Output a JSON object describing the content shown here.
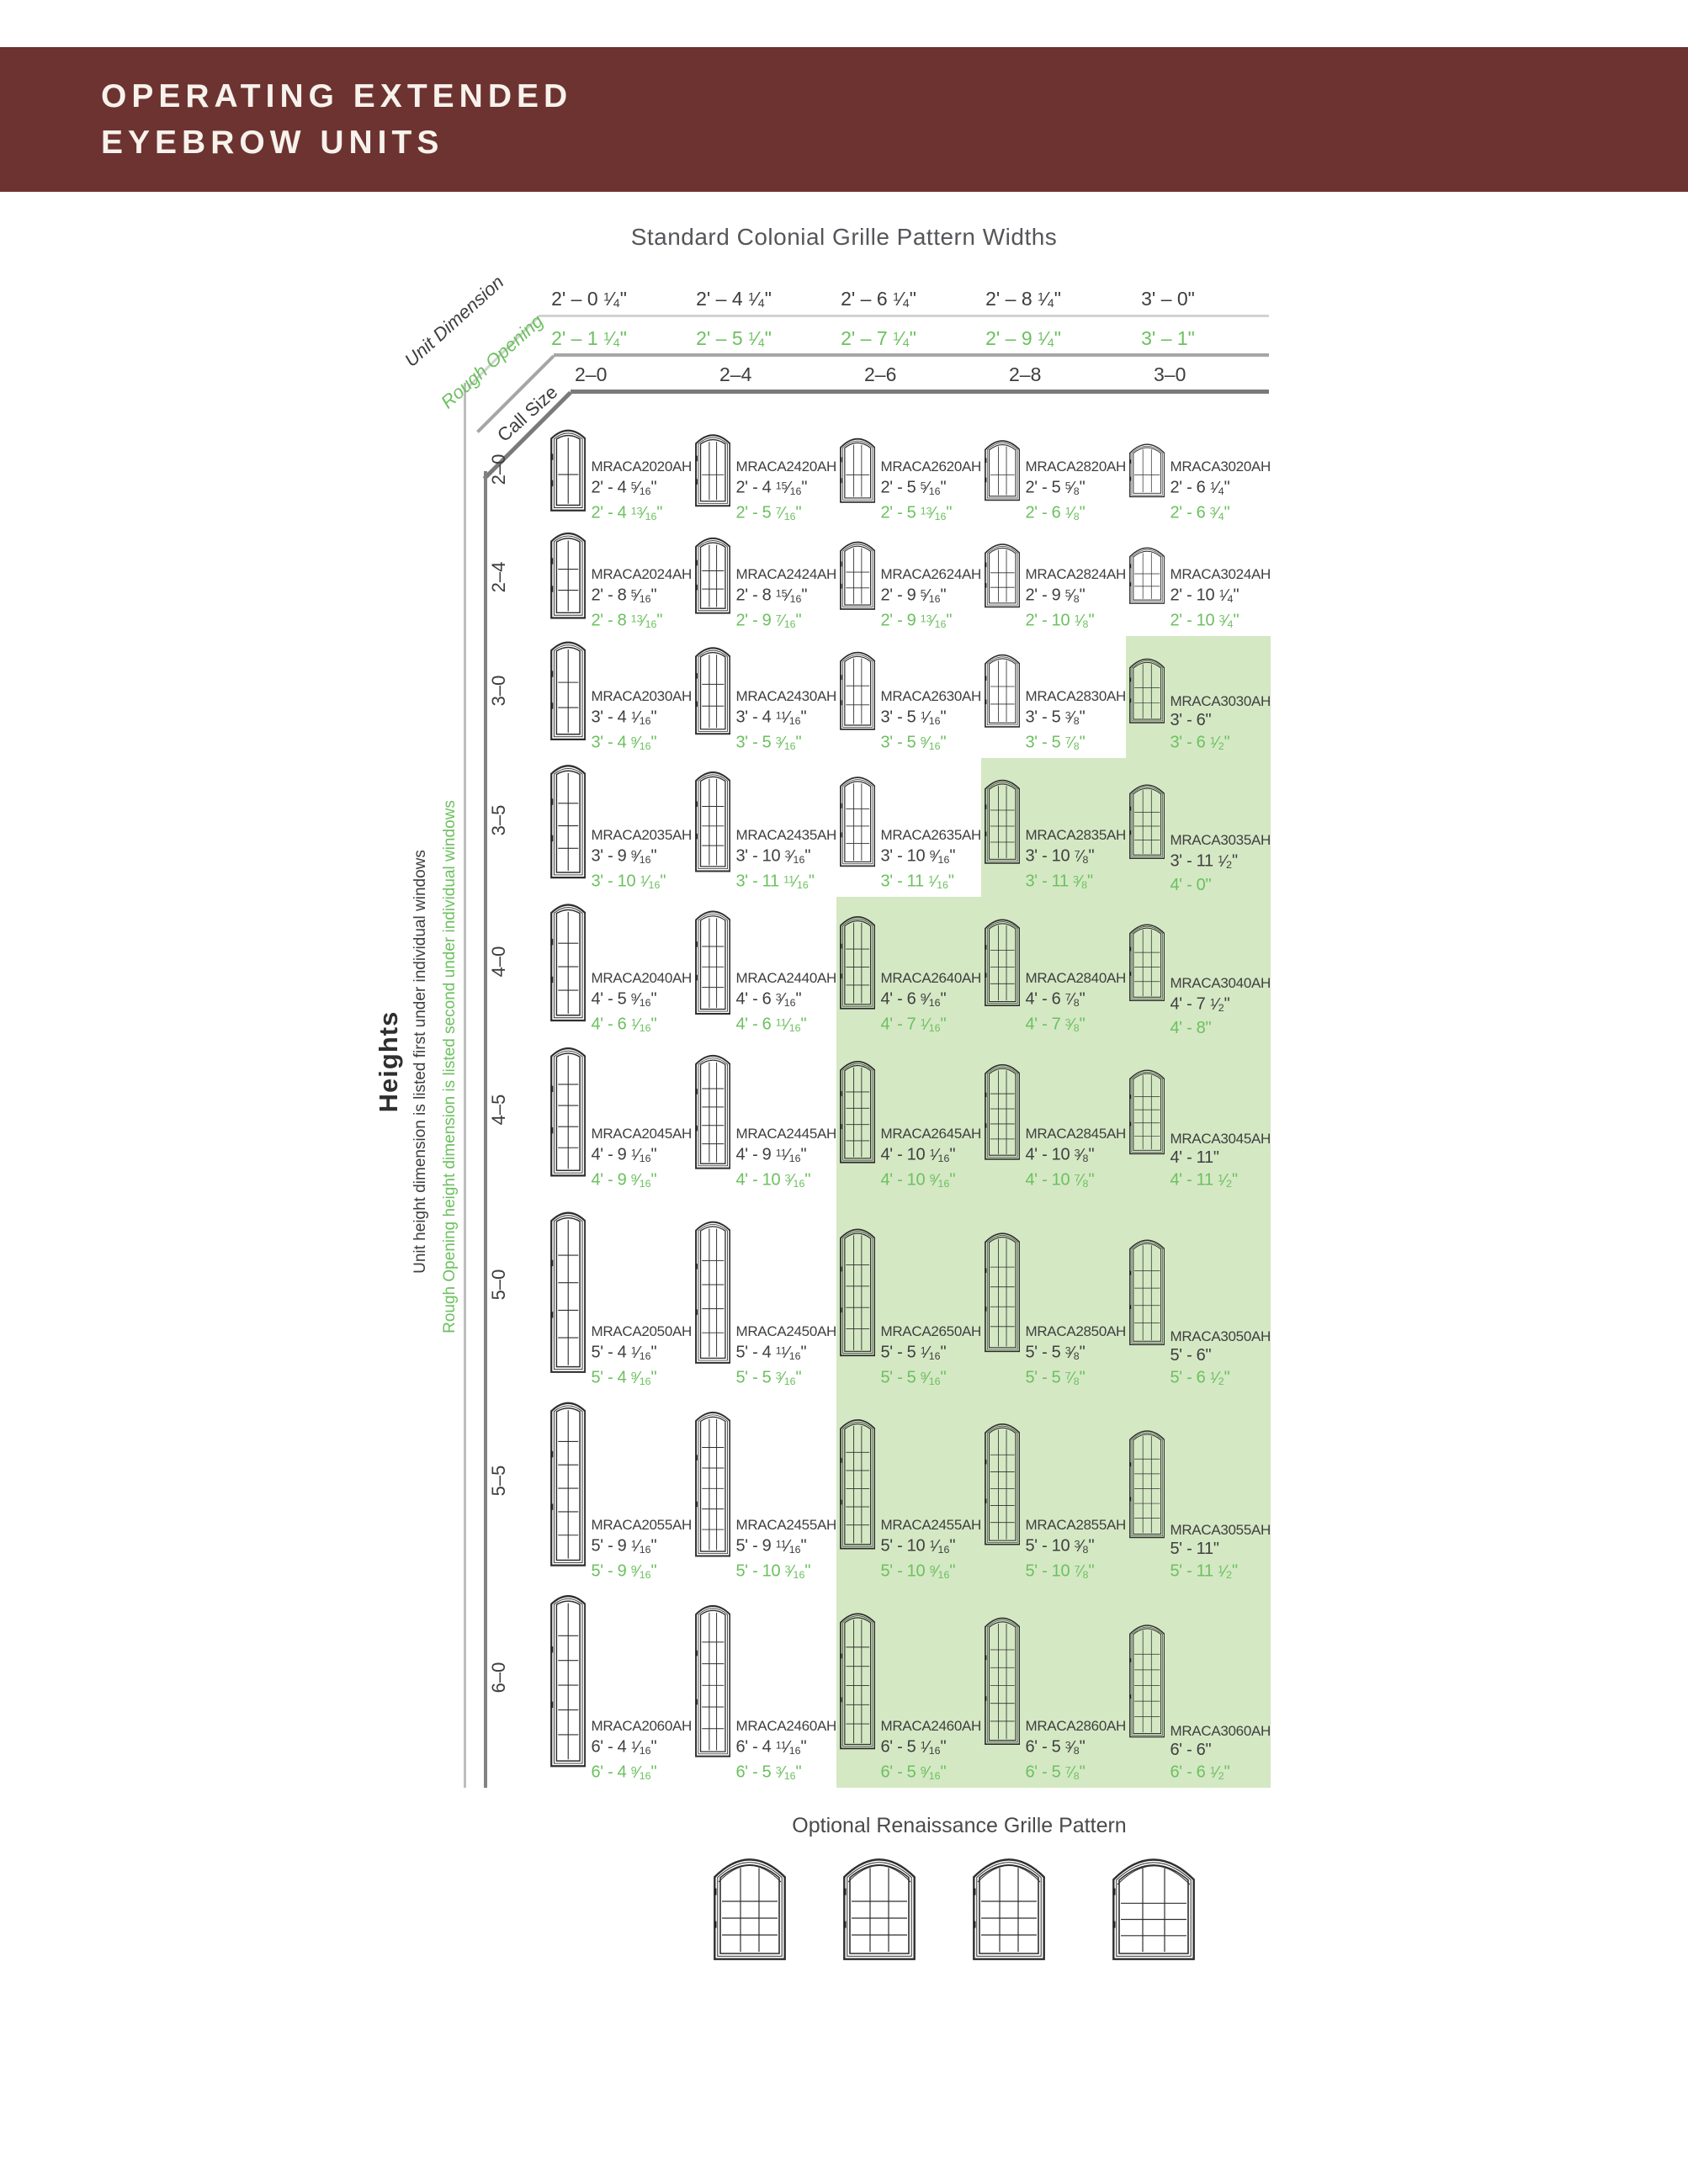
{
  "header": {
    "line1": "OPERATING EXTENDED",
    "line2": "EYEBROW UNITS"
  },
  "section_title": "Standard Colonial Grille Pattern Widths",
  "width_axis": {
    "unit_dimension_label": "Unit Dimension",
    "rough_opening_label": "Rough Opening",
    "call_size_label": "Call Size",
    "unit_dimensions": [
      "2' – 0 1/4\"",
      "2' – 4 1/4\"",
      "2' – 6 1/4\"",
      "2' – 8 1/4\"",
      "3' – 0\""
    ],
    "rough_openings": [
      "2' – 1 1/4\"",
      "2' – 5 1/4\"",
      "2' – 7 1/4\"",
      "2' – 9 1/4\"",
      "3' – 1\""
    ],
    "call_sizes": [
      "2–0",
      "2–4",
      "2–6",
      "2–8",
      "3–0"
    ]
  },
  "height_axis": {
    "title": "Heights",
    "unit_note": "Unit height dimension is listed first under individual windows",
    "rough_opening_note": "Rough Opening height dimension is listed second under individual windows"
  },
  "grid": {
    "rows": [
      {
        "call": "2–0",
        "cells": [
          {
            "model": "MRACA2020AH",
            "unit": "2' - 4 5/16\"",
            "ro": "2' - 4 13/16\"",
            "highlight": false
          },
          {
            "model": "MRACA2420AH",
            "unit": "2' - 4 15/16\"",
            "ro": "2' - 5 7/16\"",
            "highlight": false
          },
          {
            "model": "MRACA2620AH",
            "unit": "2' - 5 5/16\"",
            "ro": "2' - 5 13/16\"",
            "highlight": false
          },
          {
            "model": "MRACA2820AH",
            "unit": "2' - 5 5/8\"",
            "ro": "2' - 6 1/8\"",
            "highlight": false
          },
          {
            "model": "MRACA3020AH",
            "unit": "2' - 6 1/4\"",
            "ro": "2' - 6 3/4\"",
            "highlight": false
          }
        ]
      },
      {
        "call": "2–4",
        "cells": [
          {
            "model": "MRACA2024AH",
            "unit": "2' - 8 5/16\"",
            "ro": "2' - 8 13/16\"",
            "highlight": false
          },
          {
            "model": "MRACA2424AH",
            "unit": "2' - 8 15/16\"",
            "ro": "2' - 9 7/16\"",
            "highlight": false
          },
          {
            "model": "MRACA2624AH",
            "unit": "2' - 9 5/16\"",
            "ro": "2' - 9 13/16\"",
            "highlight": false
          },
          {
            "model": "MRACA2824AH",
            "unit": "2' - 9 5/8\"",
            "ro": "2' - 10 1/8\"",
            "highlight": false
          },
          {
            "model": "MRACA3024AH",
            "unit": "2' - 10 1/4\"",
            "ro": "2' - 10 3/4\"",
            "highlight": false
          }
        ]
      },
      {
        "call": "3–0",
        "cells": [
          {
            "model": "MRACA2030AH",
            "unit": "3' - 4 1/16\"",
            "ro": "3' - 4 9/16\"",
            "highlight": false
          },
          {
            "model": "MRACA2430AH",
            "unit": "3' - 4 11/16\"",
            "ro": "3' - 5 3/16\"",
            "highlight": false
          },
          {
            "model": "MRACA2630AH",
            "unit": "3' - 5 1/16\"",
            "ro": "3' - 5 9/16\"",
            "highlight": false
          },
          {
            "model": "MRACA2830AH",
            "unit": "3' - 5 3/8\"",
            "ro": "3' - 5 7/8\"",
            "highlight": false
          },
          {
            "model": "MRACA3030AH",
            "unit": "3' - 6\"",
            "ro": "3' - 6 1/2\"",
            "highlight": true
          }
        ]
      },
      {
        "call": "3–5",
        "cells": [
          {
            "model": "MRACA2035AH",
            "unit": "3' - 9 9/16\"",
            "ro": "3' - 10 1/16\"",
            "highlight": false
          },
          {
            "model": "MRACA2435AH",
            "unit": "3' - 10 3/16\"",
            "ro": "3' - 11 11/16\"",
            "highlight": false
          },
          {
            "model": "MRACA2635AH",
            "unit": "3' - 10 9/16\"",
            "ro": "3' - 11 1/16\"",
            "highlight": false
          },
          {
            "model": "MRACA2835AH",
            "unit": "3' - 10 7/8\"",
            "ro": "3' - 11 3/8\"",
            "highlight": true
          },
          {
            "model": "MRACA3035AH",
            "unit": "3' - 11 1/2\"",
            "ro": "4' - 0\"",
            "highlight": true
          }
        ]
      },
      {
        "call": "4–0",
        "cells": [
          {
            "model": "MRACA2040AH",
            "unit": "4' - 5 9/16\"",
            "ro": "4' - 6 1/16\"",
            "highlight": false
          },
          {
            "model": "MRACA2440AH",
            "unit": "4' - 6 3/16\"",
            "ro": "4' - 6 11/16\"",
            "highlight": false
          },
          {
            "model": "MRACA2640AH",
            "unit": "4' - 6 9/16\"",
            "ro": "4' - 7 1/16\"",
            "highlight": true
          },
          {
            "model": "MRACA2840AH",
            "unit": "4' - 6 7/8\"",
            "ro": "4' - 7 3/8\"",
            "highlight": true
          },
          {
            "model": "MRACA3040AH",
            "unit": "4' - 7 1/2\"",
            "ro": "4' - 8\"",
            "highlight": true
          }
        ]
      },
      {
        "call": "4–5",
        "cells": [
          {
            "model": "MRACA2045AH",
            "unit": "4' - 9 1/16\"",
            "ro": "4' - 9 9/16\"",
            "highlight": false
          },
          {
            "model": "MRACA2445AH",
            "unit": "4' - 9 11/16\"",
            "ro": "4' - 10 3/16\"",
            "highlight": false
          },
          {
            "model": "MRACA2645AH",
            "unit": "4' - 10 1/16\"",
            "ro": "4' - 10 9/16\"",
            "highlight": true
          },
          {
            "model": "MRACA2845AH",
            "unit": "4' - 10 3/8\"",
            "ro": "4' - 10 7/8\"",
            "highlight": true
          },
          {
            "model": "MRACA3045AH",
            "unit": "4' - 11\"",
            "ro": "4' - 11 1/2\"",
            "highlight": true
          }
        ]
      },
      {
        "call": "5–0",
        "cells": [
          {
            "model": "MRACA2050AH",
            "unit": "5' - 4 1/16\"",
            "ro": "5' - 4 9/16\"",
            "highlight": false
          },
          {
            "model": "MRACA2450AH",
            "unit": "5' - 4 11/16\"",
            "ro": "5' - 5 3/16\"",
            "highlight": false
          },
          {
            "model": "MRACA2650AH",
            "unit": "5' - 5 1/16\"",
            "ro": "5' - 5 9/16\"",
            "highlight": true
          },
          {
            "model": "MRACA2850AH",
            "unit": "5' - 5 3/8\"",
            "ro": "5' - 5 7/8\"",
            "highlight": true
          },
          {
            "model": "MRACA3050AH",
            "unit": "5' - 6\"",
            "ro": "5' - 6 1/2\"",
            "highlight": true
          }
        ]
      },
      {
        "call": "5–5",
        "cells": [
          {
            "model": "MRACA2055AH",
            "unit": "5' - 9 1/16\"",
            "ro": "5' - 9 9/16\"",
            "highlight": false
          },
          {
            "model": "MRACA2455AH",
            "unit": "5' - 9 11/16\"",
            "ro": "5' - 10 3/16\"",
            "highlight": false
          },
          {
            "model": "MRACA2455AH",
            "unit": "5' - 10 1/16\"",
            "ro": "5' - 10 9/16\"",
            "highlight": true
          },
          {
            "model": "MRACA2855AH",
            "unit": "5' - 10 3/8\"",
            "ro": "5' - 10 7/8\"",
            "highlight": true
          },
          {
            "model": "MRACA3055AH",
            "unit": "5' - 11\"",
            "ro": "5' - 11 1/2\"",
            "highlight": true
          }
        ]
      },
      {
        "call": "6–0",
        "cells": [
          {
            "model": "MRACA2060AH",
            "unit": "6' - 4 1/16\"",
            "ro": "6' - 4 9/16\"",
            "highlight": false
          },
          {
            "model": "MRACA2460AH",
            "unit": "6' - 4 11/16\"",
            "ro": "6' - 5 3/16\"",
            "highlight": false
          },
          {
            "model": "MRACA2460AH",
            "unit": "6' - 5 1/16\"",
            "ro": "6' - 5 9/16\"",
            "highlight": true
          },
          {
            "model": "MRACA2860AH",
            "unit": "6' - 5 3/8\"",
            "ro": "6' - 5 7/8\"",
            "highlight": true
          },
          {
            "model": "MRACA3060AH",
            "unit": "6' - 6\"",
            "ro": "6' - 6 1/2\"",
            "highlight": true
          }
        ]
      }
    ]
  },
  "footer": {
    "title": "Optional Renaissance Grille Pattern",
    "window_count": 4
  },
  "colors": {
    "header_bg": "#6d3331",
    "green_text": "#6cc05f",
    "highlight_bg": "#d4e8c4"
  }
}
